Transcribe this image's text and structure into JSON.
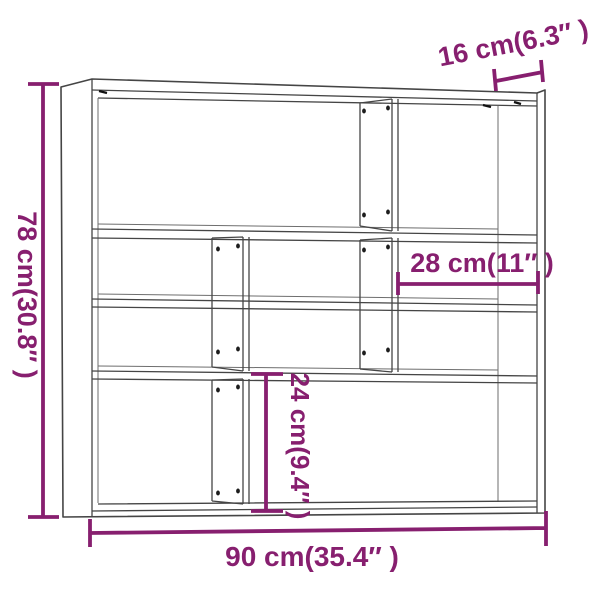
{
  "diagram": {
    "colors": {
      "dimension": "#871F6F",
      "outline": "#454545"
    },
    "labels": {
      "height": "78 cm(30.8″ )",
      "width": "90 cm(35.4″ )",
      "depth": "16 cm(6.3″ )",
      "shelf_width": "28 cm(11″ )",
      "shelf_height": "24 cm(9.4″ )"
    }
  }
}
